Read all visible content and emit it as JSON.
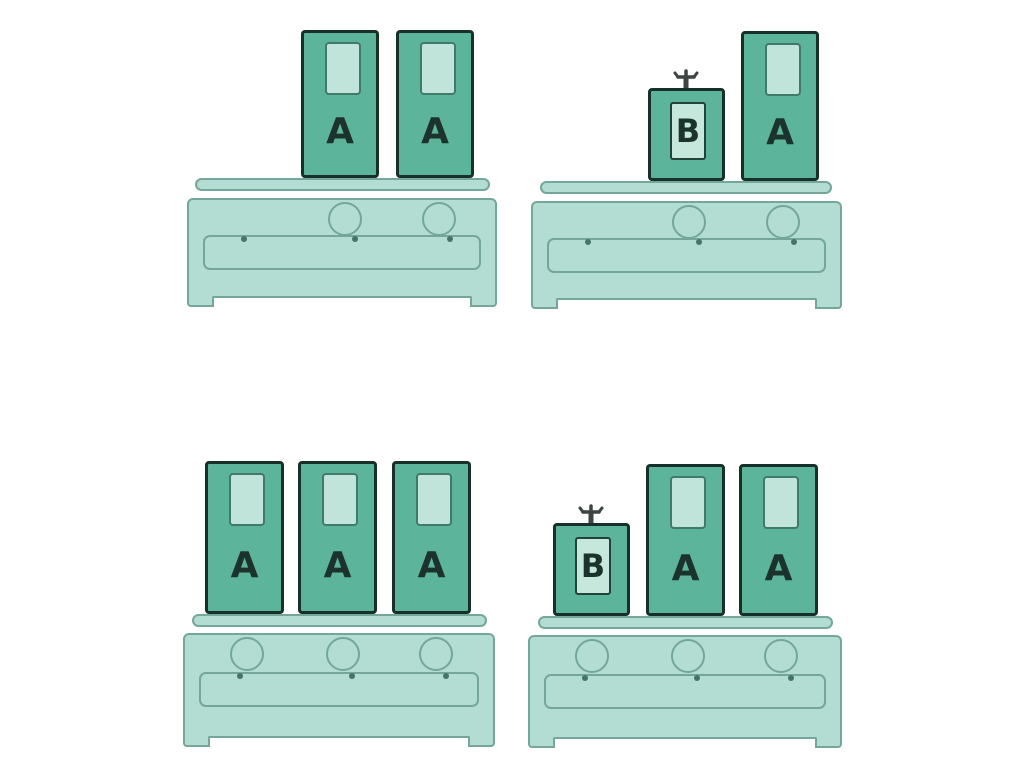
{
  "title": "Cartons A and B on kitchen benches",
  "colors": {
    "page_bg": "#ffffff",
    "carton_fill": "#5cb49b",
    "carton_border": "#18302a",
    "window_fill": "#c0e4d9",
    "window_border": "#41796a",
    "panel_fill": "#c6e7dc",
    "panel_border": "#24413a",
    "bench_fill": "#b3ddd2",
    "bench_line": "#74a69a",
    "dot": "#44746a",
    "letter": "#1b332c",
    "tap": "#3d4442"
  },
  "scenes": [
    {
      "id": "top-left",
      "knob_count": 2,
      "cartons": [
        {
          "label": "A"
        },
        {
          "label": "A"
        }
      ]
    },
    {
      "id": "top-right",
      "knob_count": 2,
      "cartons": [
        {
          "label": "B",
          "has_tap": true
        },
        {
          "label": "A"
        }
      ]
    },
    {
      "id": "bottom-left",
      "knob_count": 3,
      "cartons": [
        {
          "label": "A"
        },
        {
          "label": "A"
        },
        {
          "label": "A"
        }
      ]
    },
    {
      "id": "bottom-right",
      "knob_count": 3,
      "cartons": [
        {
          "label": "B",
          "has_tap": true
        },
        {
          "label": "A"
        },
        {
          "label": "A"
        }
      ]
    }
  ]
}
